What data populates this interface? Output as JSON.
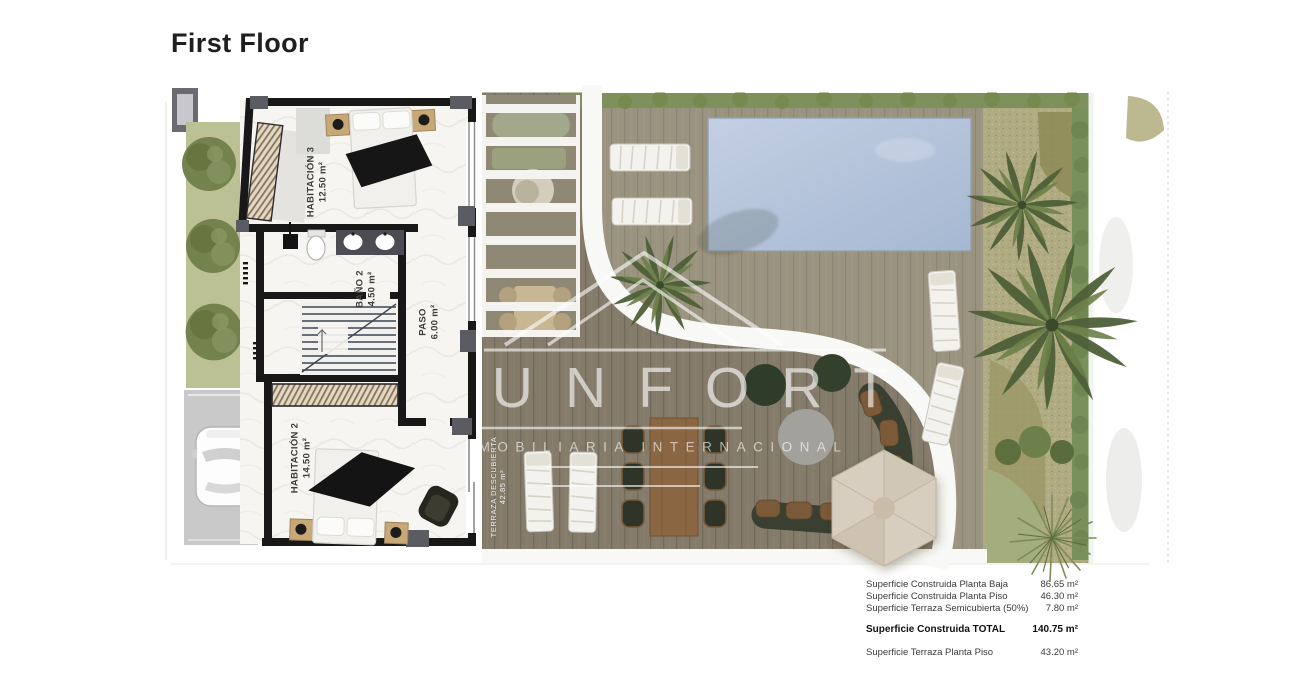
{
  "title": "First Floor",
  "plan": {
    "rooms": [
      {
        "name": "HABITACIÓN 3",
        "area": "12.50 m²"
      },
      {
        "name": "BAÑO 2",
        "area": "4.50 m²"
      },
      {
        "name": "PASO",
        "area": "6.00 m²"
      },
      {
        "name": "HABITACIÓN 2",
        "area": "14.50 m²"
      },
      {
        "name": "TERRAZA DESCUBIERTA",
        "area": "42.85 m²"
      }
    ]
  },
  "watermark": {
    "brand": "UNFORT",
    "subtitle": "MOBILIARIA INTERNACIONAL"
  },
  "areas": {
    "rows": [
      {
        "label": "Superficie Construida Planta Baja",
        "value": "86.65 m²"
      },
      {
        "label": "Superficie Construida Planta Piso",
        "value": "46.30 m²"
      },
      {
        "label": "Superficie Terraza Semicubierta (50%)",
        "value": "7.80 m²"
      },
      {
        "label": "Superficie Construida TOTAL",
        "value": "140.75 m²"
      },
      {
        "label": "Superficie Terraza Planta Piso",
        "value": "43.20 m²"
      }
    ]
  },
  "palette": {
    "pool": "#b3c4dc",
    "deck_light": "#9a937f",
    "deck_dark": "#857c6b",
    "walls": "#181818",
    "door_block": "#5b5b62",
    "grass": "#bcc195",
    "hedge": "#76894f",
    "gravel": "#b0ab82",
    "wood_furniture": "#8a6742",
    "parasol": "#d8cec0",
    "watermark_white": "rgba(255,255,255,0.62)"
  }
}
